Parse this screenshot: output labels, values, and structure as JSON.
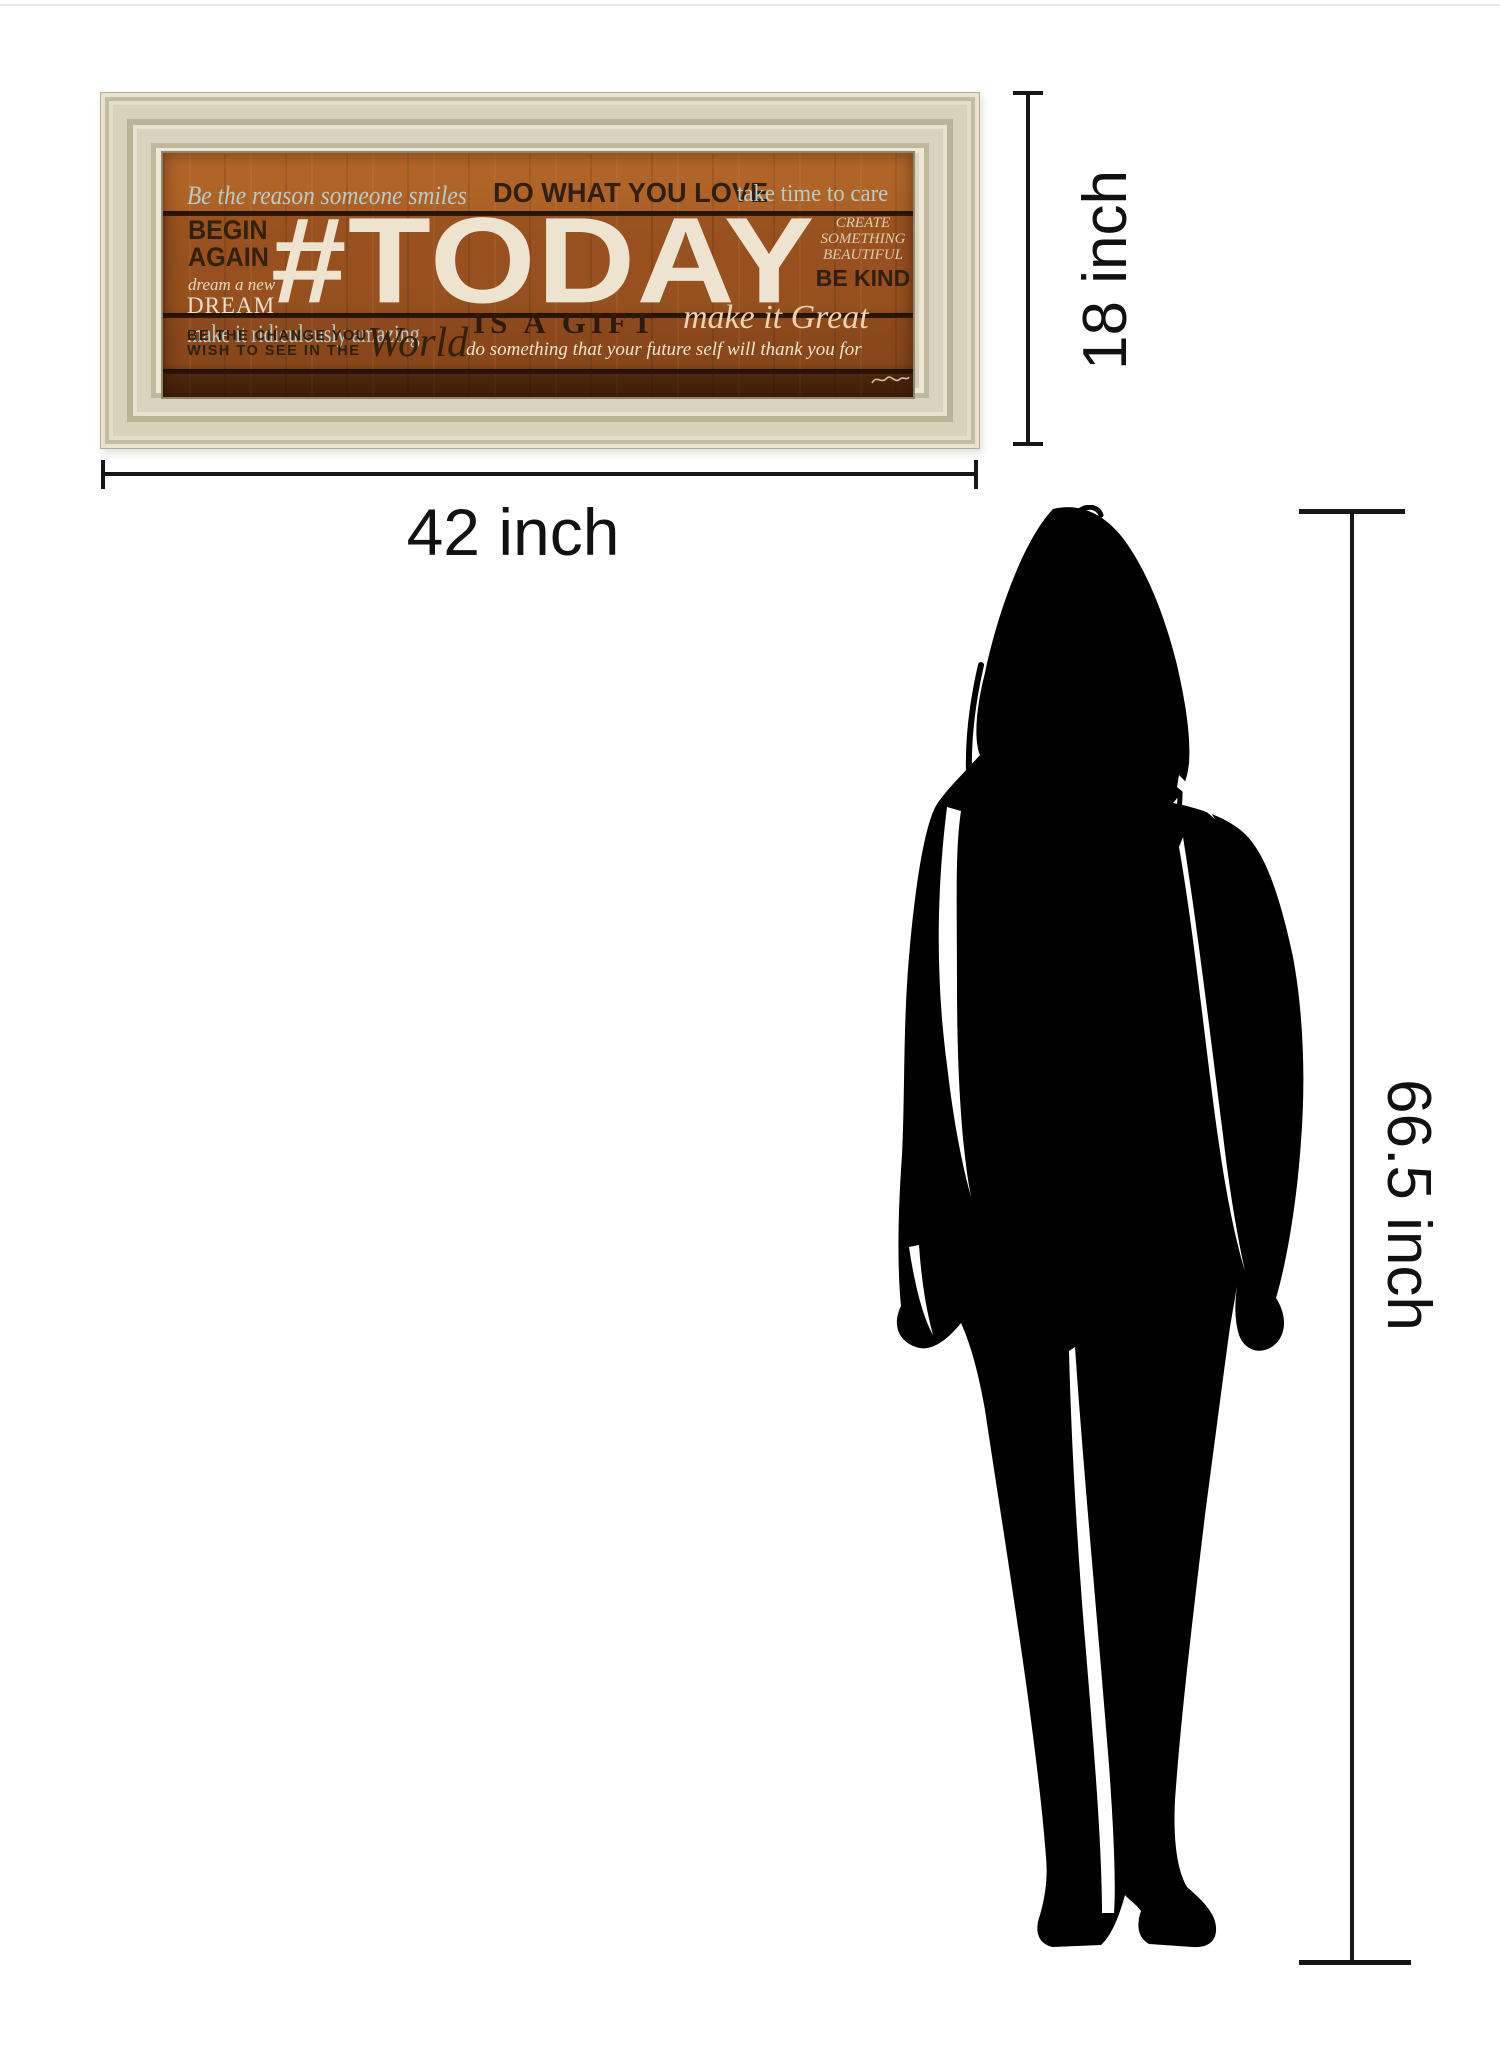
{
  "artwork": {
    "line1": {
      "script_left": "Be the reason someone smiles",
      "caps_center": "DO WHAT YOU LOVE",
      "serif_right": "take time to care"
    },
    "line2": {
      "begin_again": "BEGIN\nAGAIN",
      "dream_script": "dream a new",
      "dream": "DREAM",
      "today": "#TODAY",
      "create": "CREATE\nSOMETHING\nBEAUTIFUL",
      "be_kind": "BE KIND"
    },
    "line3": {
      "amazing": "make it ridiculously amazing",
      "gift": "IS A GIFT",
      "great": "make it Great",
      "change_line1": "BE THE CHANGE YOU",
      "change_line2": "WISH TO SEE IN THE",
      "world": "World",
      "future": "do something that your future self will thank you for"
    }
  },
  "dimension_annotations": {
    "art_width": "42 inch",
    "art_height": "18 inch",
    "person_height": "66.5 inch"
  },
  "colors": {
    "frame_cream": "#ddd7c1",
    "wood_orange": "#9a521e",
    "wood_dark_plank": "#5f300f",
    "divider_dark": "#1d0f08",
    "text_light_blue": "#b4cccb",
    "text_cream": "#e6dcc3",
    "text_dark_brown": "#2f2012",
    "today_white": "#ece3d1",
    "dimension_line": "#161616",
    "silhouette": "#000000"
  }
}
